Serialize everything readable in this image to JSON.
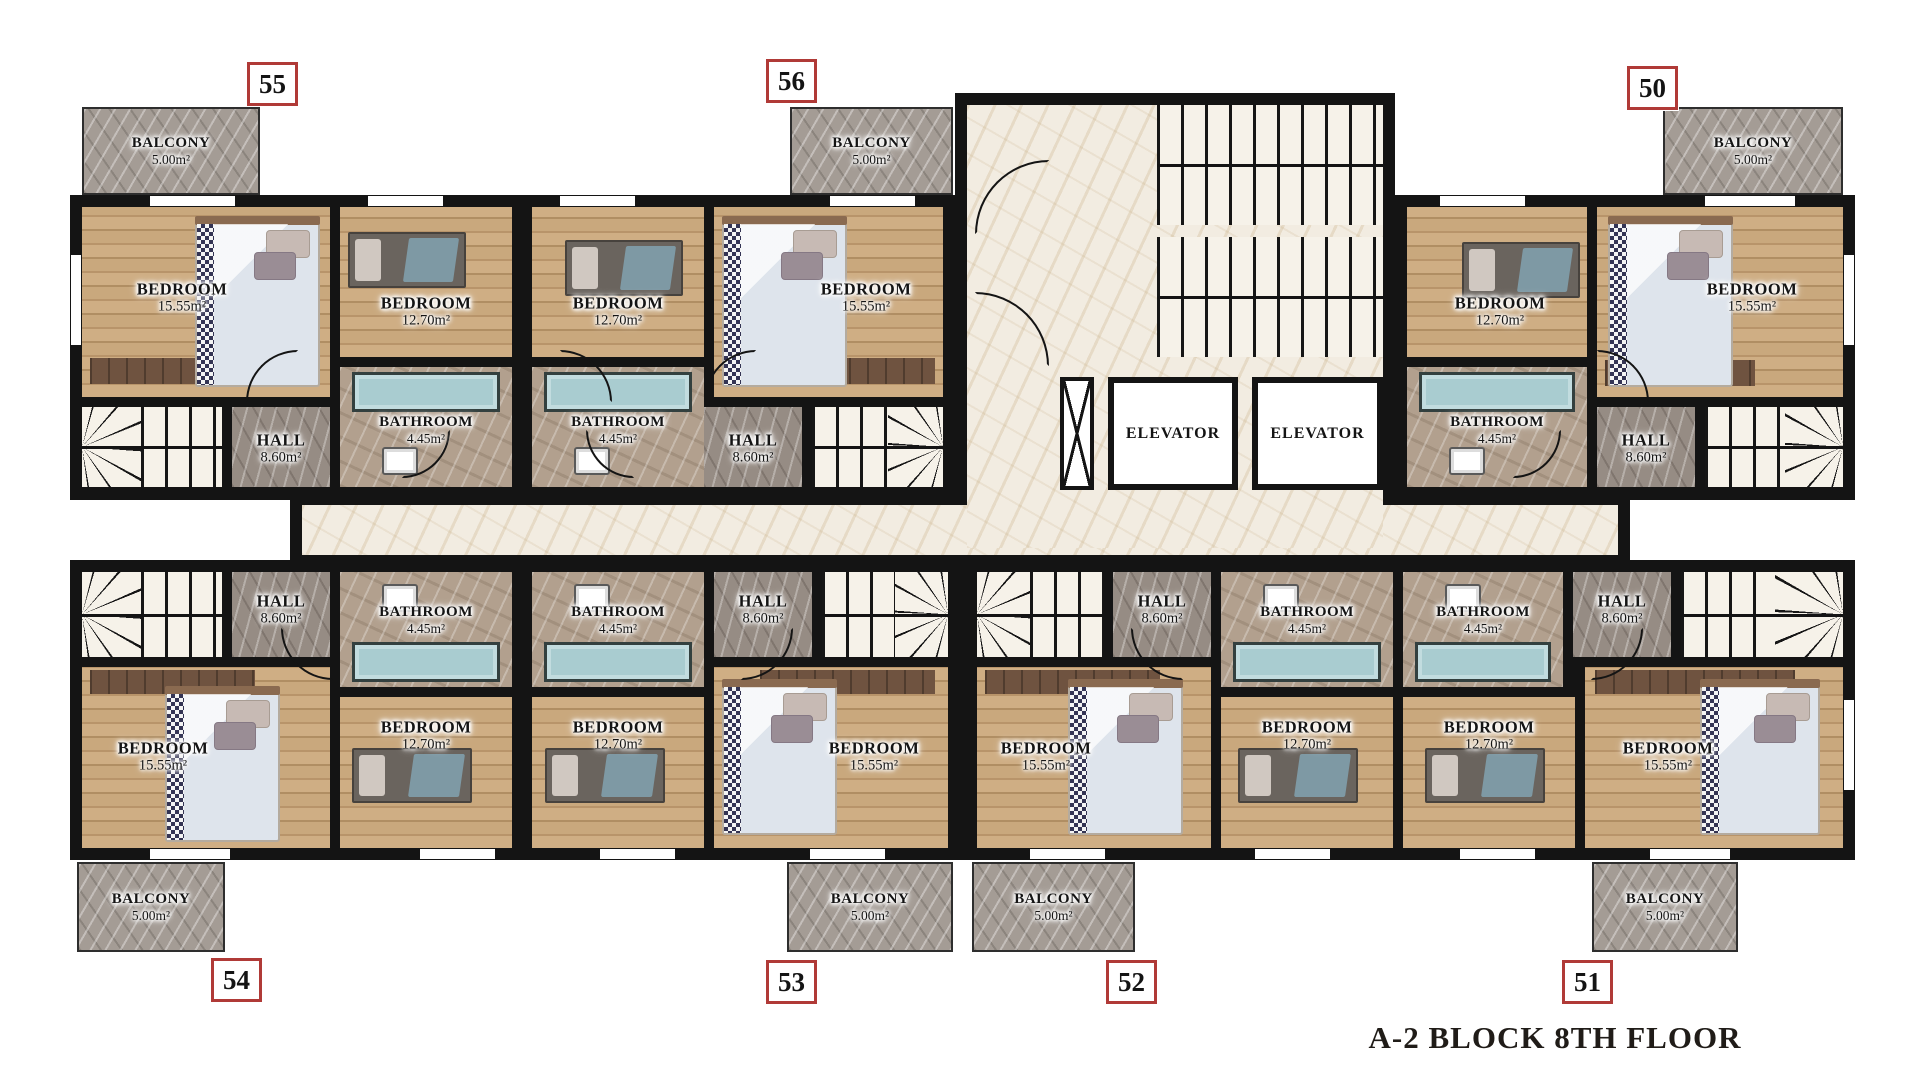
{
  "title": "A-2 BLOCK 8TH FLOOR",
  "legend": {
    "bedroom_label": "BEDROOM",
    "bathroom_label": "BATHROOM",
    "hall_label": "HALL",
    "balcony_label": "BALCONY",
    "elevator_label": "ELEVATOR",
    "bedroom_large_area": "15.55m²",
    "bedroom_small_area": "12.70m²",
    "bathroom_area": "4.45m²",
    "hall_area": "8.60m²",
    "balcony_area": "5.00m²"
  },
  "colors": {
    "wall": "#141414",
    "badge_border": "#b03a37",
    "wood": "#c9a87d",
    "marble": "#f2ece1",
    "hall_gray": "#968c84",
    "balcony_gray": "#a49c95",
    "tub_teal": "#a9ccd0"
  },
  "unit_badges": [
    {
      "no": "55",
      "x": 247,
      "y": 62
    },
    {
      "no": "56",
      "x": 766,
      "y": 59
    },
    {
      "no": "50",
      "x": 1627,
      "y": 66
    },
    {
      "no": "54",
      "x": 211,
      "y": 958
    },
    {
      "no": "53",
      "x": 766,
      "y": 960
    },
    {
      "no": "52",
      "x": 1106,
      "y": 960
    },
    {
      "no": "51",
      "x": 1562,
      "y": 960
    }
  ],
  "floorplan": {
    "canvas": {
      "w": 1920,
      "h": 1080
    },
    "base_blocks": [
      {
        "x": 70,
        "y": 195,
        "w": 885,
        "h": 305
      },
      {
        "x": 1395,
        "y": 195,
        "w": 460,
        "h": 305
      },
      {
        "x": 955,
        "y": 93,
        "w": 440,
        "h": 467
      },
      {
        "x": 290,
        "y": 493,
        "w": 1340,
        "h": 74
      },
      {
        "x": 70,
        "y": 560,
        "w": 1785,
        "h": 300
      }
    ],
    "windows": [
      {
        "x": 150,
        "y": 196,
        "w": 85,
        "h": 10
      },
      {
        "x": 368,
        "y": 196,
        "w": 75,
        "h": 10
      },
      {
        "x": 560,
        "y": 196,
        "w": 75,
        "h": 10
      },
      {
        "x": 830,
        "y": 196,
        "w": 85,
        "h": 10
      },
      {
        "x": 1440,
        "y": 196,
        "w": 85,
        "h": 10
      },
      {
        "x": 1705,
        "y": 196,
        "w": 90,
        "h": 10
      },
      {
        "x": 150,
        "y": 849,
        "w": 80,
        "h": 10
      },
      {
        "x": 420,
        "y": 849,
        "w": 75,
        "h": 10
      },
      {
        "x": 600,
        "y": 849,
        "w": 75,
        "h": 10
      },
      {
        "x": 810,
        "y": 849,
        "w": 75,
        "h": 10
      },
      {
        "x": 1030,
        "y": 849,
        "w": 75,
        "h": 10
      },
      {
        "x": 1255,
        "y": 849,
        "w": 75,
        "h": 10
      },
      {
        "x": 1460,
        "y": 849,
        "w": 75,
        "h": 10
      },
      {
        "x": 1650,
        "y": 849,
        "w": 80,
        "h": 10
      },
      {
        "x": 71,
        "y": 255,
        "w": 10,
        "h": 90
      },
      {
        "x": 1844,
        "y": 255,
        "w": 10,
        "h": 90
      },
      {
        "x": 1844,
        "y": 700,
        "w": 10,
        "h": 90
      }
    ],
    "rooms": [
      {
        "id": "bedroom-15-55-u55",
        "type": "bedroom",
        "label": "BEDROOM",
        "area": "15.55m²",
        "x": 82,
        "y": 207,
        "w": 248,
        "h": 190,
        "lx": 182,
        "ly": 298
      },
      {
        "id": "bedroom-12-70-u55",
        "type": "bedroom",
        "label": "BEDROOM",
        "area": "12.70m²",
        "x": 340,
        "y": 207,
        "w": 172,
        "h": 150,
        "lx": 426,
        "ly": 312
      },
      {
        "id": "bathroom-u55",
        "type": "bathroom",
        "label": "BATHROOM",
        "area": "4.45m²",
        "x": 340,
        "y": 367,
        "w": 172,
        "h": 120,
        "lx": 426,
        "ly": 430
      },
      {
        "id": "hall-u55",
        "type": "hall",
        "label": "HALL",
        "area": "8.60m²",
        "x": 232,
        "y": 407,
        "w": 98,
        "h": 80,
        "lx": 281,
        "ly": 449
      },
      {
        "id": "bedroom-12-70-u56",
        "type": "bedroom",
        "label": "BEDROOM",
        "area": "12.70m²",
        "x": 532,
        "y": 207,
        "w": 172,
        "h": 150,
        "lx": 618,
        "ly": 312
      },
      {
        "id": "bedroom-15-55-u56",
        "type": "bedroom",
        "label": "BEDROOM",
        "area": "15.55m²",
        "x": 714,
        "y": 207,
        "w": 229,
        "h": 190,
        "lx": 866,
        "ly": 298
      },
      {
        "id": "bathroom-u56",
        "type": "bathroom",
        "label": "BATHROOM",
        "area": "4.45m²",
        "x": 532,
        "y": 367,
        "w": 172,
        "h": 120,
        "lx": 618,
        "ly": 430
      },
      {
        "id": "hall-u56",
        "type": "hall",
        "label": "HALL",
        "area": "8.60m²",
        "x": 704,
        "y": 407,
        "w": 98,
        "h": 80,
        "lx": 753,
        "ly": 449
      },
      {
        "id": "bedroom-12-70-u50",
        "type": "bedroom",
        "label": "BEDROOM",
        "area": "12.70m²",
        "x": 1407,
        "y": 207,
        "w": 180,
        "h": 150,
        "lx": 1500,
        "ly": 312
      },
      {
        "id": "bedroom-15-55-u50",
        "type": "bedroom",
        "label": "BEDROOM",
        "area": "15.55m²",
        "x": 1597,
        "y": 207,
        "w": 246,
        "h": 190,
        "lx": 1752,
        "ly": 298
      },
      {
        "id": "bathroom-u50",
        "type": "bathroom",
        "label": "BATHROOM",
        "area": "4.45m²",
        "x": 1407,
        "y": 367,
        "w": 180,
        "h": 120,
        "lx": 1497,
        "ly": 430
      },
      {
        "id": "hall-u50",
        "type": "hall",
        "label": "HALL",
        "area": "8.60m²",
        "x": 1597,
        "y": 407,
        "w": 98,
        "h": 80,
        "lx": 1646,
        "ly": 449
      },
      {
        "id": "hall-u54",
        "type": "hall",
        "label": "HALL",
        "area": "8.60m²",
        "x": 232,
        "y": 572,
        "w": 98,
        "h": 85,
        "lx": 281,
        "ly": 610
      },
      {
        "id": "bathroom-u54",
        "type": "bathroom",
        "label": "BATHROOM",
        "area": "4.45m²",
        "x": 340,
        "y": 572,
        "w": 172,
        "h": 115,
        "lx": 426,
        "ly": 620
      },
      {
        "id": "bedroom-15-55-u54",
        "type": "bedroom",
        "label": "BEDROOM",
        "area": "15.55m²",
        "x": 82,
        "y": 667,
        "w": 248,
        "h": 181,
        "lx": 163,
        "ly": 757
      },
      {
        "id": "bedroom-12-70-u54",
        "type": "bedroom",
        "label": "BEDROOM",
        "area": "12.70m²",
        "x": 340,
        "y": 697,
        "w": 172,
        "h": 151,
        "lx": 426,
        "ly": 736
      },
      {
        "id": "bathroom-u53",
        "type": "bathroom",
        "label": "BATHROOM",
        "area": "4.45m²",
        "x": 532,
        "y": 572,
        "w": 172,
        "h": 115,
        "lx": 618,
        "ly": 620
      },
      {
        "id": "bedroom-12-70-u53",
        "type": "bedroom",
        "label": "BEDROOM",
        "area": "12.70m²",
        "x": 532,
        "y": 697,
        "w": 172,
        "h": 151,
        "lx": 618,
        "ly": 736
      },
      {
        "id": "hall-u53",
        "type": "hall",
        "label": "HALL",
        "area": "8.60m²",
        "x": 714,
        "y": 572,
        "w": 98,
        "h": 85,
        "lx": 763,
        "ly": 610
      },
      {
        "id": "bedroom-15-55-u53",
        "type": "bedroom",
        "label": "BEDROOM",
        "area": "15.55m²",
        "x": 714,
        "y": 667,
        "w": 234,
        "h": 181,
        "lx": 874,
        "ly": 757
      },
      {
        "id": "bedroom-15-55-u52",
        "type": "bedroom",
        "label": "BEDROOM",
        "area": "15.55m²",
        "x": 977,
        "y": 667,
        "w": 234,
        "h": 181,
        "lx": 1046,
        "ly": 757
      },
      {
        "id": "hall-u52",
        "type": "hall",
        "label": "HALL",
        "area": "8.60m²",
        "x": 1113,
        "y": 572,
        "w": 98,
        "h": 85,
        "lx": 1162,
        "ly": 610
      },
      {
        "id": "bathroom-u52",
        "type": "bathroom",
        "label": "BATHROOM",
        "area": "4.45m²",
        "x": 1221,
        "y": 572,
        "w": 172,
        "h": 115,
        "lx": 1307,
        "ly": 620
      },
      {
        "id": "bedroom-12-70-u52",
        "type": "bedroom",
        "label": "BEDROOM",
        "area": "12.70m²",
        "x": 1221,
        "y": 697,
        "w": 172,
        "h": 151,
        "lx": 1307,
        "ly": 736
      },
      {
        "id": "bathroom-u51",
        "type": "bathroom",
        "label": "BATHROOM",
        "area": "4.45m²",
        "x": 1403,
        "y": 572,
        "w": 160,
        "h": 115,
        "lx": 1483,
        "ly": 620
      },
      {
        "id": "bedroom-12-70-u51",
        "type": "bedroom",
        "label": "BEDROOM",
        "area": "12.70m²",
        "x": 1403,
        "y": 697,
        "w": 172,
        "h": 151,
        "lx": 1489,
        "ly": 736
      },
      {
        "id": "hall-u51",
        "type": "hall",
        "label": "HALL",
        "area": "8.60m²",
        "x": 1573,
        "y": 572,
        "w": 98,
        "h": 85,
        "lx": 1622,
        "ly": 610
      },
      {
        "id": "bedroom-15-55-u51",
        "type": "bedroom",
        "label": "BEDROOM",
        "area": "15.55m²",
        "x": 1585,
        "y": 667,
        "w": 258,
        "h": 181,
        "lx": 1668,
        "ly": 757
      },
      {
        "id": "central-corridor",
        "type": "marble",
        "label": "",
        "area": "",
        "x": 302,
        "y": 505,
        "w": 1316,
        "h": 50
      },
      {
        "id": "core-lobby",
        "type": "marble",
        "label": "",
        "area": "",
        "x": 967,
        "y": 105,
        "w": 416,
        "h": 443
      }
    ],
    "balconies": [
      {
        "unit": "55",
        "label": "BALCONY",
        "area": "5.00m²",
        "x": 82,
        "y": 107,
        "w": 178,
        "h": 88
      },
      {
        "unit": "56",
        "label": "BALCONY",
        "area": "5.00m²",
        "x": 790,
        "y": 107,
        "w": 163,
        "h": 88
      },
      {
        "unit": "50",
        "label": "BALCONY",
        "area": "5.00m²",
        "x": 1663,
        "y": 107,
        "w": 180,
        "h": 88
      },
      {
        "unit": "54",
        "label": "BALCONY",
        "area": "5.00m²",
        "x": 77,
        "y": 862,
        "w": 148,
        "h": 90
      },
      {
        "unit": "53",
        "label": "BALCONY",
        "area": "5.00m²",
        "x": 787,
        "y": 862,
        "w": 166,
        "h": 90
      },
      {
        "unit": "52",
        "label": "BALCONY",
        "area": "5.00m²",
        "x": 972,
        "y": 862,
        "w": 163,
        "h": 90
      },
      {
        "unit": "51",
        "label": "BALCONY",
        "area": "5.00m²",
        "x": 1592,
        "y": 862,
        "w": 146,
        "h": 90
      }
    ],
    "stairs": [
      {
        "x": 82,
        "y": 407,
        "w": 140,
        "h": 80,
        "fan": "left"
      },
      {
        "x": 812,
        "y": 407,
        "w": 131,
        "h": 80,
        "fan": "right"
      },
      {
        "x": 1705,
        "y": 407,
        "w": 138,
        "h": 80,
        "fan": "right"
      },
      {
        "x": 82,
        "y": 572,
        "w": 140,
        "h": 85,
        "fan": "left"
      },
      {
        "x": 822,
        "y": 572,
        "w": 126,
        "h": 85,
        "fan": "right"
      },
      {
        "x": 977,
        "y": 572,
        "w": 126,
        "h": 85,
        "fan": "left"
      },
      {
        "x": 1681,
        "y": 572,
        "w": 162,
        "h": 85,
        "fan": "right"
      },
      {
        "x": 1157,
        "y": 105,
        "w": 226,
        "h": 120,
        "fan": "none"
      },
      {
        "x": 1157,
        "y": 237,
        "w": 226,
        "h": 120,
        "fan": "none"
      }
    ],
    "elevators": [
      {
        "label": "ELEVATOR",
        "x": 1108,
        "y": 377,
        "w": 130,
        "h": 113
      },
      {
        "label": "ELEVATOR",
        "x": 1252,
        "y": 377,
        "w": 131,
        "h": 113
      }
    ],
    "shaft": {
      "x": 1060,
      "y": 377,
      "w": 34,
      "h": 113
    },
    "furniture": {
      "double_beds": [
        {
          "x": 195,
          "y": 222,
          "w": 125,
          "h": 165
        },
        {
          "x": 722,
          "y": 222,
          "w": 125,
          "h": 165
        },
        {
          "x": 1608,
          "y": 222,
          "w": 125,
          "h": 165
        },
        {
          "x": 165,
          "y": 692,
          "w": 115,
          "h": 150
        },
        {
          "x": 722,
          "y": 685,
          "w": 115,
          "h": 150
        },
        {
          "x": 1068,
          "y": 685,
          "w": 115,
          "h": 150
        },
        {
          "x": 1700,
          "y": 685,
          "w": 120,
          "h": 150
        }
      ],
      "single_beds": [
        {
          "x": 348,
          "y": 232,
          "w": 118,
          "h": 56
        },
        {
          "x": 565,
          "y": 240,
          "w": 118,
          "h": 56
        },
        {
          "x": 1462,
          "y": 242,
          "w": 118,
          "h": 56
        },
        {
          "x": 352,
          "y": 748,
          "w": 120,
          "h": 55
        },
        {
          "x": 545,
          "y": 748,
          "w": 120,
          "h": 55
        },
        {
          "x": 1238,
          "y": 748,
          "w": 120,
          "h": 55
        },
        {
          "x": 1425,
          "y": 748,
          "w": 120,
          "h": 55
        }
      ],
      "wardrobes": [
        {
          "x": 90,
          "y": 358,
          "w": 155,
          "h": 26
        },
        {
          "x": 795,
          "y": 358,
          "w": 140,
          "h": 26
        },
        {
          "x": 1605,
          "y": 360,
          "w": 150,
          "h": 26
        },
        {
          "x": 90,
          "y": 670,
          "w": 165,
          "h": 24
        },
        {
          "x": 760,
          "y": 670,
          "w": 175,
          "h": 24
        },
        {
          "x": 985,
          "y": 670,
          "w": 175,
          "h": 24
        },
        {
          "x": 1595,
          "y": 670,
          "w": 200,
          "h": 24
        }
      ],
      "tubs": [
        {
          "x": 352,
          "y": 372,
          "w": 148,
          "h": 40
        },
        {
          "x": 544,
          "y": 372,
          "w": 148,
          "h": 40
        },
        {
          "x": 1419,
          "y": 372,
          "w": 156,
          "h": 40
        },
        {
          "x": 352,
          "y": 642,
          "w": 148,
          "h": 40
        },
        {
          "x": 544,
          "y": 642,
          "w": 148,
          "h": 40
        },
        {
          "x": 1233,
          "y": 642,
          "w": 148,
          "h": 40
        },
        {
          "x": 1415,
          "y": 642,
          "w": 136,
          "h": 40
        }
      ],
      "sinks": [
        {
          "x": 382,
          "y": 447,
          "w": 36,
          "h": 28
        },
        {
          "x": 574,
          "y": 447,
          "w": 36,
          "h": 28
        },
        {
          "x": 1449,
          "y": 447,
          "w": 36,
          "h": 28
        },
        {
          "x": 382,
          "y": 584,
          "w": 36,
          "h": 28
        },
        {
          "x": 574,
          "y": 584,
          "w": 36,
          "h": 28
        },
        {
          "x": 1263,
          "y": 584,
          "w": 36,
          "h": 28
        },
        {
          "x": 1445,
          "y": 584,
          "w": 36,
          "h": 28
        }
      ]
    },
    "door_arcs": [
      {
        "x": 246,
        "y": 350,
        "s": 52,
        "rot": 0
      },
      {
        "x": 560,
        "y": 350,
        "s": 52,
        "rot": 90
      },
      {
        "x": 704,
        "y": 350,
        "s": 52,
        "rot": 0
      },
      {
        "x": 975,
        "y": 160,
        "s": 74,
        "rot": 0
      },
      {
        "x": 975,
        "y": 292,
        "s": 74,
        "rot": 90
      },
      {
        "x": 1597,
        "y": 350,
        "s": 52,
        "rot": 90
      },
      {
        "x": 402,
        "y": 430,
        "s": 48,
        "rot": 180
      },
      {
        "x": 586,
        "y": 430,
        "s": 48,
        "rot": 270
      },
      {
        "x": 1513,
        "y": 430,
        "s": 48,
        "rot": 180
      },
      {
        "x": 281,
        "y": 628,
        "s": 52,
        "rot": 270
      },
      {
        "x": 741,
        "y": 628,
        "s": 52,
        "rot": 180
      },
      {
        "x": 1131,
        "y": 628,
        "s": 52,
        "rot": 270
      },
      {
        "x": 1591,
        "y": 628,
        "s": 52,
        "rot": 180
      }
    ]
  }
}
